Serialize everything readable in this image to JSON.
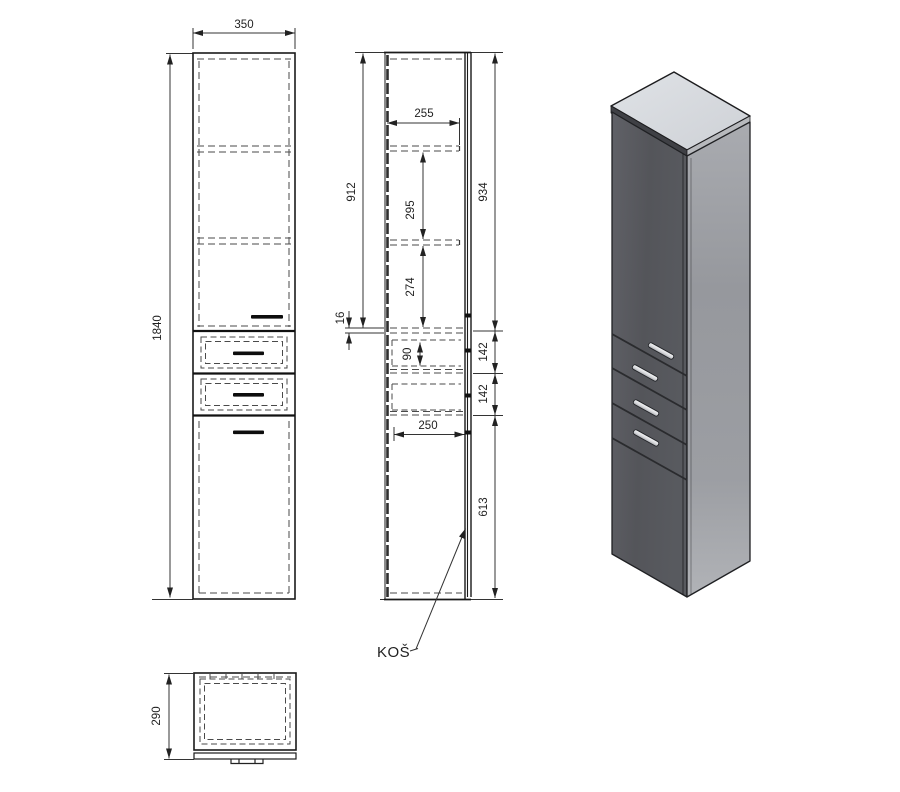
{
  "drawing": {
    "front_view": {
      "width_mm": "350",
      "height_mm": "1840"
    },
    "side_view": {
      "interior_height": "912",
      "shelf_depth": "255",
      "upper_shelf_space": "295",
      "lower_shelf_space": "274",
      "shelf_thickness": "16",
      "drawer_inner_height": "90",
      "upper_door_height": "934",
      "drawer_front_1": "142",
      "drawer_front_2": "142",
      "lower_door_height": "613",
      "basket_depth": "250",
      "basket_label": "KOŠ"
    },
    "top_view": {
      "depth_mm": "290"
    }
  }
}
